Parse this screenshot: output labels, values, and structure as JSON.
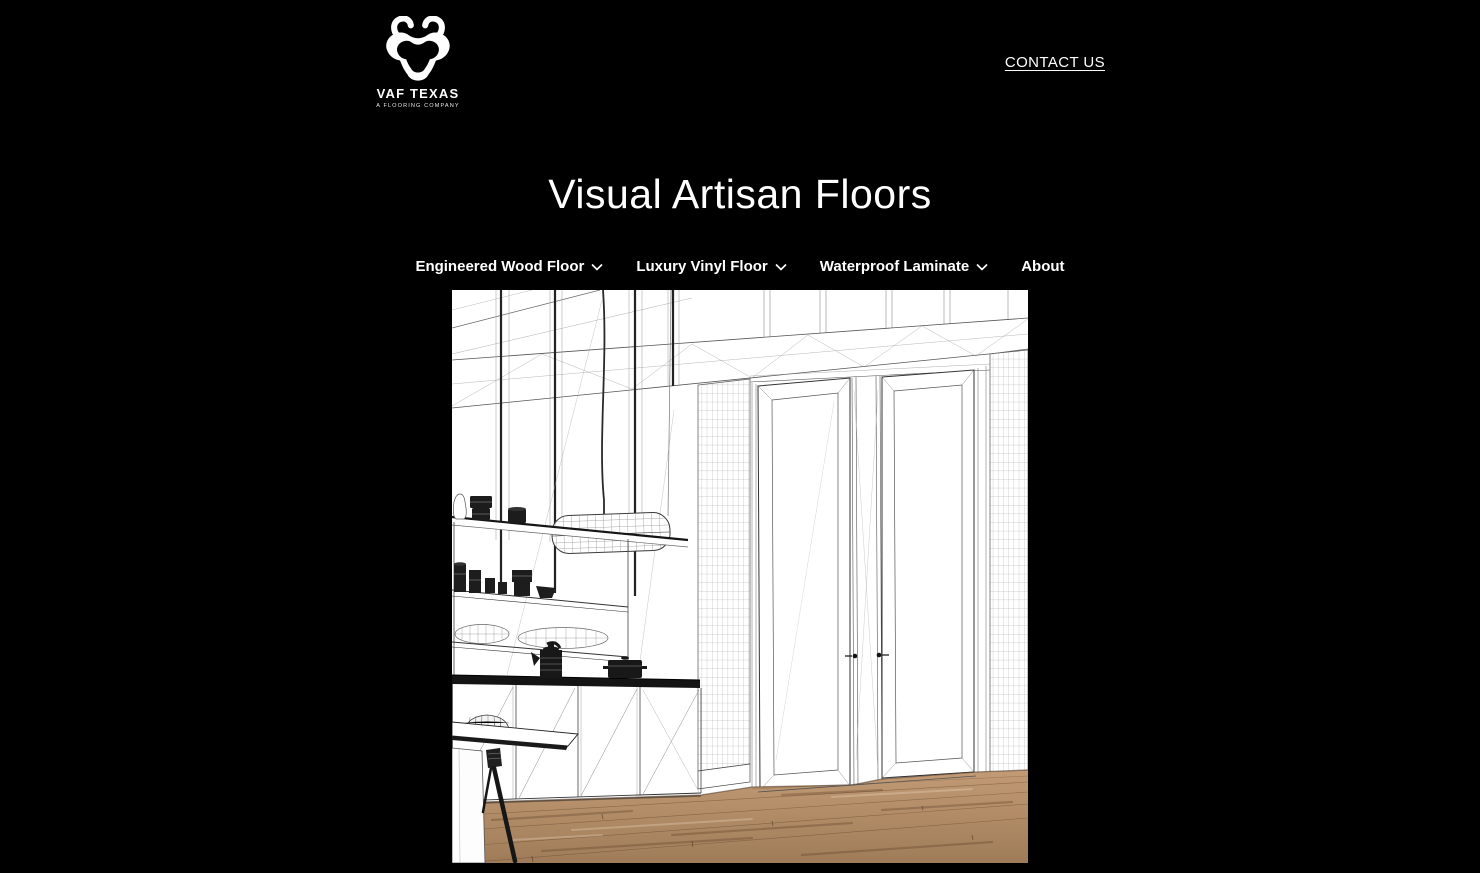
{
  "header": {
    "logo": {
      "name": "VAF TEXAS",
      "tagline": "A FLOORING COMPANY"
    },
    "contact_label": "CONTACT US"
  },
  "hero": {
    "title": "Visual Artisan Floors"
  },
  "nav": {
    "items": [
      {
        "label": "Engineered Wood Floor",
        "has_dropdown": true
      },
      {
        "label": "Luxury Vinyl Floor",
        "has_dropdown": true
      },
      {
        "label": "Waterproof Laminate",
        "has_dropdown": true
      },
      {
        "label": "About",
        "has_dropdown": false
      }
    ]
  },
  "hero_image": {
    "description": "Black-and-white wireframe sketch of a tall modern kitchen: open shelving with dark pots and jars, pendant lamp, kitchen island, table and chair, large double doors and grid-tiled wall columns; only the floor is rendered as realistic wood planks",
    "floor_color": "#b3906c"
  },
  "colors": {
    "background": "#000000",
    "text": "#ffffff",
    "sketch_line": "#333333",
    "wood_light": "#c29b76",
    "wood_dark": "#9f7c59"
  }
}
